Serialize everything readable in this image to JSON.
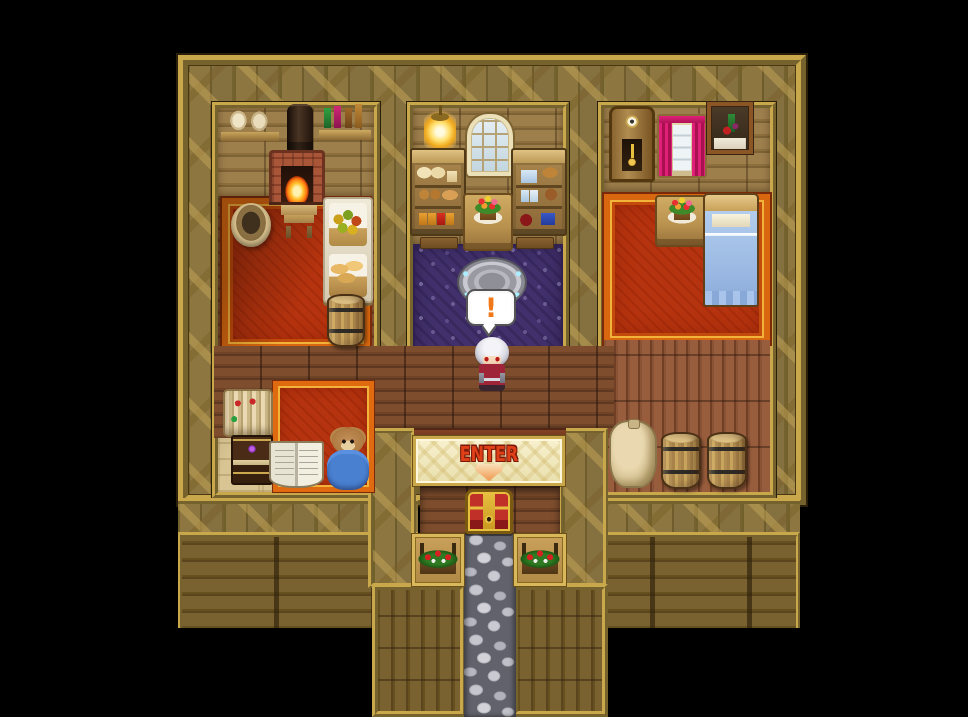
{
  "scene": {
    "balloon_text": "!",
    "enter_label": "ENTER"
  },
  "palette": {
    "background": "#000000",
    "gold_frame": "#c9a84c",
    "cross_wall": "#7d6936",
    "hall_floor": "#734628",
    "carpet_red": "#b5330e",
    "carpet_purple": "#41306b",
    "banner_cream": "#f8f1ce",
    "enter_text": "#e04018",
    "balloon_exclaim": "#f07818",
    "stone_path": "#9a9aa4",
    "curtain_pink": "#e02078",
    "bed_blue": "#a8c4ea"
  },
  "items": [
    {
      "type": "shelf-sacks",
      "name": "wall-shelf-sacks",
      "x": 221,
      "y": 103,
      "w": 58,
      "h": 38,
      "interactable": false
    },
    {
      "type": "chimney",
      "name": "fireplace-chimney",
      "x": 287,
      "y": 104,
      "w": 26,
      "h": 48,
      "interactable": false
    },
    {
      "type": "shelf-bottles",
      "name": "wall-shelf-bottles",
      "x": 319,
      "y": 100,
      "w": 52,
      "h": 40,
      "interactable": false
    },
    {
      "type": "fireplace",
      "name": "fireplace",
      "x": 269,
      "y": 150,
      "w": 56,
      "h": 52,
      "interactable": true
    },
    {
      "type": "bucket",
      "name": "wooden-tub",
      "x": 231,
      "y": 203,
      "w": 40,
      "h": 44,
      "interactable": false
    },
    {
      "type": "bench",
      "name": "small-bench",
      "x": 281,
      "y": 205,
      "w": 36,
      "h": 33,
      "interactable": false
    },
    {
      "type": "basket-stand",
      "name": "produce-basket-stand",
      "x": 323,
      "y": 197,
      "w": 50,
      "h": 106,
      "interactable": true
    },
    {
      "type": "barrel",
      "name": "barrel-storage-room",
      "x": 327,
      "y": 294,
      "w": 38,
      "h": 53,
      "interactable": false
    },
    {
      "type": "carpet-small",
      "name": "study-rug",
      "x": 273,
      "y": 381,
      "w": 101,
      "h": 111,
      "interactable": false
    },
    {
      "type": "scrolls",
      "name": "scroll-pile",
      "x": 223,
      "y": 389,
      "w": 50,
      "h": 48,
      "interactable": true
    },
    {
      "type": "book-stack",
      "name": "book-stack",
      "x": 231,
      "y": 435,
      "w": 42,
      "h": 50,
      "interactable": true
    },
    {
      "type": "open-book",
      "name": "open-book",
      "x": 269,
      "y": 441,
      "w": 55,
      "h": 47,
      "interactable": true
    },
    {
      "type": "teddy-bear",
      "name": "teddy-bear",
      "x": 327,
      "y": 428,
      "w": 42,
      "h": 62,
      "interactable": true
    },
    {
      "type": "hanging-lamp",
      "name": "hanging-lamp",
      "x": 424,
      "y": 105,
      "w": 32,
      "h": 46,
      "interactable": false
    },
    {
      "type": "window-arched",
      "name": "arched-window",
      "x": 467,
      "y": 114,
      "w": 46,
      "h": 62,
      "interactable": false
    },
    {
      "type": "cupboard-bread",
      "name": "bread-cupboard",
      "x": 410,
      "y": 148,
      "w": 56,
      "h": 88,
      "interactable": true
    },
    {
      "type": "cupboard-jars",
      "name": "jar-cupboard",
      "x": 511,
      "y": 148,
      "w": 56,
      "h": 88,
      "interactable": true
    },
    {
      "type": "doormat",
      "name": "doormat-left",
      "x": 420,
      "y": 237,
      "w": 38,
      "h": 12,
      "interactable": false
    },
    {
      "type": "doormat",
      "name": "doormat-right",
      "x": 516,
      "y": 237,
      "w": 38,
      "h": 12,
      "interactable": false
    },
    {
      "type": "table-flowers",
      "name": "flower-table-center",
      "x": 463,
      "y": 193,
      "w": 50,
      "h": 58,
      "interactable": false
    },
    {
      "type": "magic-disc",
      "name": "stone-seal",
      "x": 459,
      "y": 259,
      "w": 66,
      "h": 46,
      "interactable": true
    },
    {
      "type": "grandfather-clock",
      "name": "grandfather-clock",
      "x": 609,
      "y": 106,
      "w": 46,
      "h": 76,
      "interactable": true
    },
    {
      "type": "window-curtains",
      "name": "curtained-window",
      "x": 657,
      "y": 114,
      "w": 50,
      "h": 64,
      "interactable": false
    },
    {
      "type": "painting",
      "name": "still-life-painting",
      "x": 707,
      "y": 102,
      "w": 46,
      "h": 52,
      "interactable": false
    },
    {
      "type": "table-flowers",
      "name": "flower-table-bedroom",
      "x": 655,
      "y": 195,
      "w": 54,
      "h": 52,
      "interactable": false
    },
    {
      "type": "bed",
      "name": "bed",
      "x": 703,
      "y": 193,
      "w": 56,
      "h": 114,
      "interactable": true
    },
    {
      "type": "sack-large",
      "name": "grain-sack",
      "x": 609,
      "y": 420,
      "w": 48,
      "h": 68,
      "interactable": false
    },
    {
      "type": "barrel",
      "name": "barrel-right-1",
      "x": 661,
      "y": 432,
      "w": 40,
      "h": 57,
      "interactable": false
    },
    {
      "type": "barrel",
      "name": "barrel-right-2",
      "x": 707,
      "y": 432,
      "w": 40,
      "h": 57,
      "interactable": false
    },
    {
      "type": "treasure-chest",
      "name": "treasure-chest",
      "x": 465,
      "y": 489,
      "w": 48,
      "h": 45,
      "interactable": true
    },
    {
      "type": "flower-box",
      "name": "flower-box-left",
      "x": 412,
      "y": 534,
      "w": 52,
      "h": 52,
      "interactable": false
    },
    {
      "type": "flower-box",
      "name": "flower-box-right",
      "x": 514,
      "y": 534,
      "w": 52,
      "h": 52,
      "interactable": false
    },
    {
      "type": "character",
      "name": "player-character",
      "x": 472,
      "y": 337,
      "w": 40,
      "h": 54,
      "interactable": true
    }
  ]
}
